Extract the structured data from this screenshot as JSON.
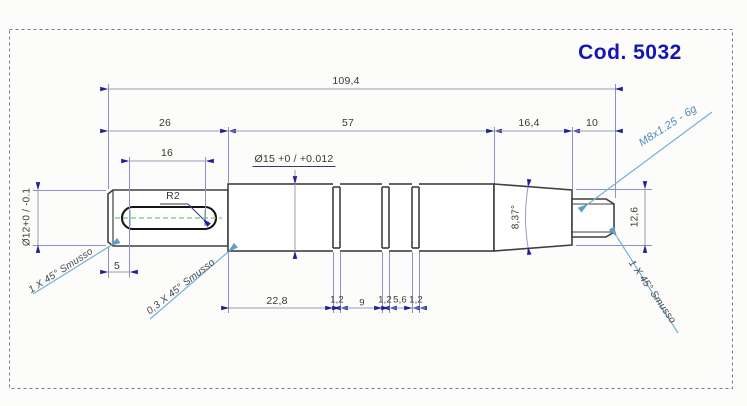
{
  "title_block": {
    "code": "Cod. 5032"
  },
  "dimensions": {
    "overall_length": "109,4",
    "segment_1": "26",
    "segment_2": "57",
    "segment_3": "16,4",
    "segment_4": "10",
    "keyway_length": "16",
    "keyway_radius": "R2",
    "main_diameter": "Ø15 +0 / +0.012",
    "left_diameter": "Ø12+0 / -0.1",
    "keyway_offset": "5",
    "taper_angle": "8,37°",
    "shoulder_diameter": "12,6",
    "groove_span": "22,8",
    "groove_1_width": "1,2",
    "groove_gap_1": "9",
    "groove_2_width": "1,2",
    "groove_gap_2": "5,6",
    "groove_3_width": "1,2"
  },
  "callouts": {
    "thread_spec": "M8x1.25 - 6g",
    "chamfer_left": "1 X 45° Smusso",
    "chamfer_step": "0,3 X 45° Smusso",
    "chamfer_right": "1 X 45° Smusso"
  },
  "colors": {
    "accent_blue": "#1414b8",
    "outline": "#3f3f3f",
    "dimension_line": "#9b9bb6",
    "extension_line": "#8f8fca",
    "arrow": "#1f1f9e",
    "leader": "#76b0d4",
    "thread_callout": "#4e8cb4",
    "centerline_green": "#79c479"
  }
}
